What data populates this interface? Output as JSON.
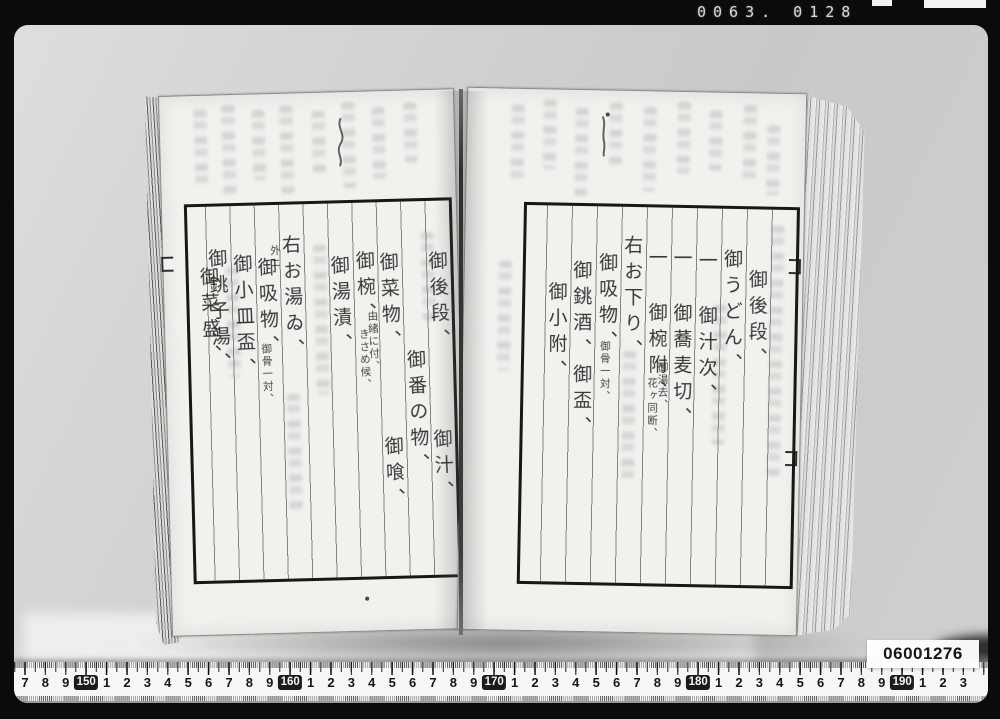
{
  "photo": {
    "counter": "0063. 0128",
    "catalog_label": "06001276"
  },
  "ruler": {
    "boxed_values": [
      "150",
      "160",
      "170",
      "180",
      "190"
    ],
    "unit_numbers": [
      "7",
      "8",
      "9",
      "150",
      "1",
      "2",
      "3",
      "4",
      "5",
      "6",
      "7",
      "8",
      "9",
      "160",
      "1",
      "2",
      "3",
      "4",
      "5",
      "6",
      "7",
      "8",
      "9",
      "170",
      "1",
      "2",
      "3",
      "4",
      "5",
      "6",
      "7",
      "8",
      "9",
      "180",
      "1",
      "2",
      "3",
      "4",
      "5",
      "6",
      "7",
      "8",
      "9",
      "190",
      "1",
      "2",
      "3"
    ]
  },
  "manuscript": {
    "right_page": {
      "columns": [
        [],
        [
          {
            "t": "御後段、",
            "top": 58
          }
        ],
        [
          {
            "t": "御うどん、",
            "top": 38
          }
        ],
        [
          {
            "t": "一 御汁次、",
            "top": 40
          }
        ],
        [
          {
            "t": "一 御蕎麦切、",
            "top": 38
          }
        ],
        [
          {
            "t": "一 御椀附、",
            "top": 38
          },
          {
            "t": "御湯去、",
            "top": 152,
            "s": 1,
            "dx": 4
          },
          {
            "t": "花ヶ同断、",
            "top": 168,
            "s": 1,
            "dx": -6
          }
        ],
        [
          {
            "t": "右お下り、",
            "top": 26
          }
        ],
        [
          {
            "t": "御吸物、",
            "top": 44
          },
          {
            "t": "御骨一対、",
            "top": 132,
            "s": 1,
            "dx": -4
          }
        ],
        [
          {
            "t": "御銚酒、御盃、",
            "top": 52
          }
        ],
        [
          {
            "t": "御小附、",
            "top": 74
          }
        ],
        []
      ]
    },
    "left_page": {
      "columns": [
        [
          {
            "t": "御後段、",
            "top": 48
          },
          {
            "t": "御汁、",
            "top": 226
          }
        ],
        [
          {
            "t": "御番の物、",
            "top": 146
          }
        ],
        [
          {
            "t": "御菜物、",
            "top": 48
          },
          {
            "t": "御喰、",
            "top": 232
          }
        ],
        [
          {
            "t": "御椀、",
            "top": 46
          },
          {
            "t": "由緒に付、",
            "top": 106,
            "s": 1,
            "dx": 4
          },
          {
            "t": "きさめ候、",
            "top": 124,
            "s": 1,
            "dx": -5
          }
        ],
        [
          {
            "t": "御湯漬、",
            "top": 50
          }
        ],
        [],
        [
          {
            "t": "右お湯ゐ、",
            "top": 28
          }
        ],
        [
          {
            "t": "外ニ",
            "top": 38,
            "s": 1,
            "dx": 6
          },
          {
            "t": "御吸物、",
            "top": 50
          },
          {
            "t": "御骨一対、",
            "top": 136,
            "s": 1,
            "dx": -5
          }
        ],
        [
          {
            "t": "御小皿盃、",
            "top": 46
          }
        ],
        [
          {
            "t": "御銚子湯、",
            "top": 40
          },
          {
            "t": "御菜盛、",
            "top": 58,
            "dx": -9
          }
        ],
        []
      ]
    }
  }
}
